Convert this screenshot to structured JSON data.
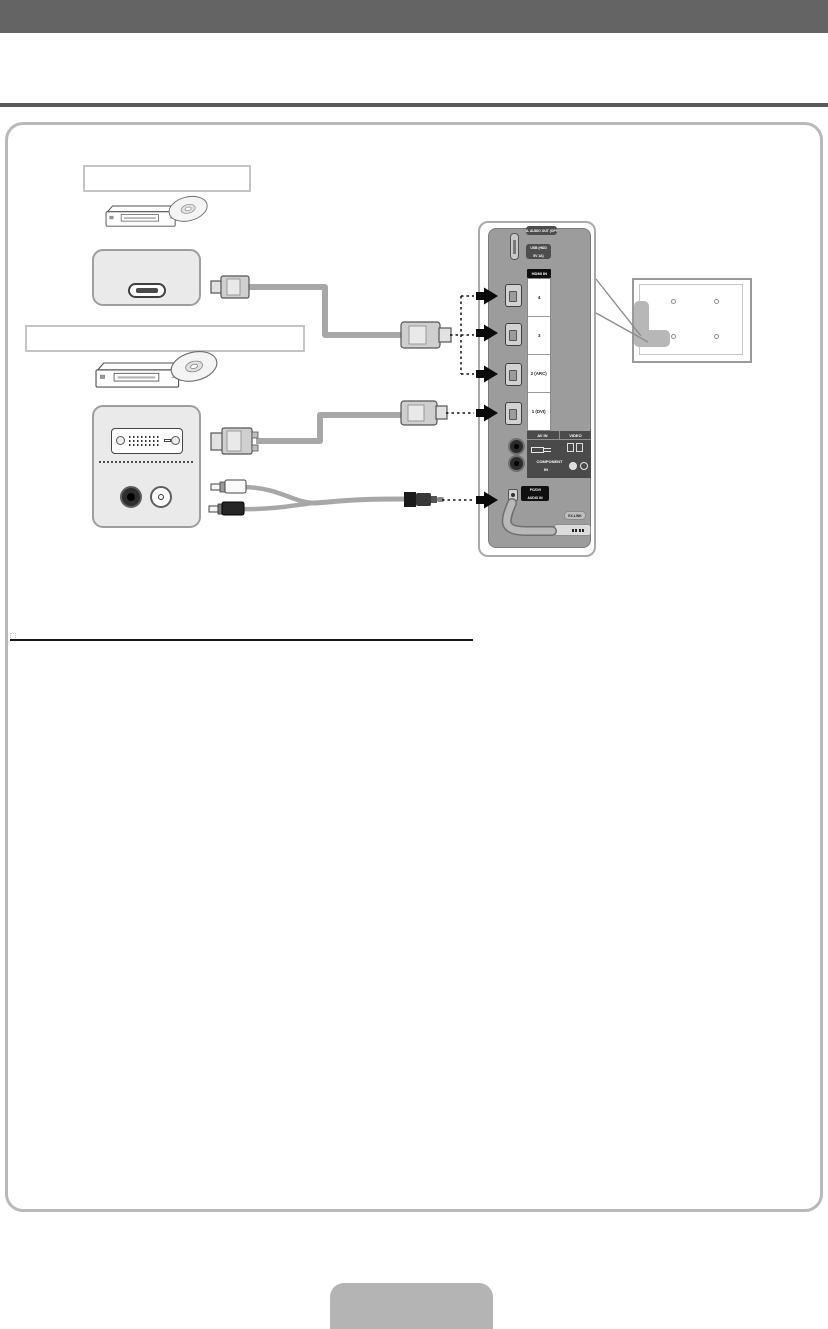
{
  "page": {
    "kind": "TV user-manual connection diagram page (HDMI / DVI connection)",
    "header_text": "",
    "colors": {
      "header_bar": "#646464",
      "top_rule": "#58595b",
      "panel_border": "#b9b9b9",
      "cable_gray": "#a7a7a7",
      "tv_panel_gray": "#9c9c9c",
      "arrow_black": "#0a0a0a",
      "footer_tab": "#b4b4b4"
    }
  },
  "labels": {
    "device_label_1": "",
    "device_label_2": "",
    "footer_tab": ""
  },
  "tv_panel": {
    "digital_audio_out": "DIGITAL AUDIO OUT (OPTICAL)",
    "usb_line1": "USB (HDD",
    "usb_line2": "5V 1A)",
    "hdmi_in": "HDMI IN",
    "hdmi_ports": [
      "4",
      "3",
      "2 (ARC)",
      "1 (DVI)"
    ],
    "av_in": "AV IN",
    "video": "VIDEO",
    "component_line1": "COMPONENT",
    "component_line2": "IN",
    "pc_dvi_line1": "PC/DVI",
    "pc_dvi_line2": "AUDIO IN",
    "ex_link": "EX-LINK"
  }
}
